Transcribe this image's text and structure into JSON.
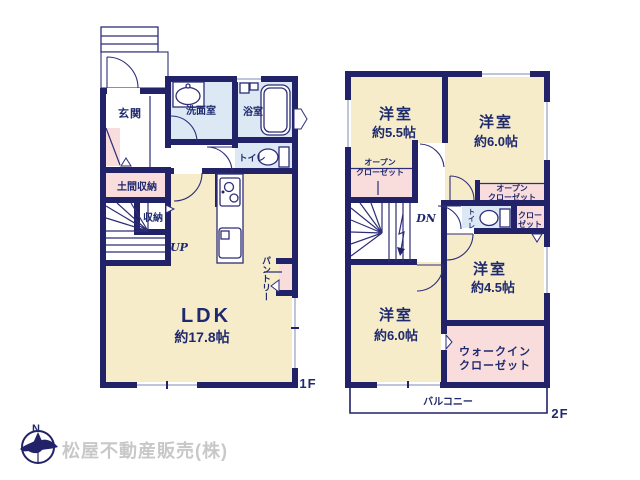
{
  "colors": {
    "wall": "#222269",
    "room_cream": "#f6ecca",
    "wet_blue": "#dce8f4",
    "closet_pink": "#f9dcdc",
    "text_navy": "#1f2a6e",
    "logo_gray": "#c8c8c8"
  },
  "floor1": {
    "label": "1F",
    "genkan": "玄関",
    "washroom": "洗面室",
    "bathroom": "浴室",
    "toilet": "トイレ",
    "doma_storage": "土間収納",
    "storage": "収納",
    "ldk": "LDK",
    "ldk_size": "約17.8帖",
    "pantry": "パントリー",
    "stairs_dir": "UP"
  },
  "floor2": {
    "label": "2F",
    "room55": "洋室",
    "room55_size": "約5.5帖",
    "room60_top": "洋室",
    "room60_top_size": "約6.0帖",
    "room45": "洋室",
    "room45_size": "約4.5帖",
    "room60_bottom": "洋室",
    "room60_bottom_size": "約6.0帖",
    "open_closet_left_line1": "オープン",
    "open_closet_left_line2": "クローゼット",
    "open_closet_right_line1": "オープン",
    "open_closet_right_line2": "クローゼット",
    "closet_line1": "クロー",
    "closet_line2": "ゼット",
    "toilet": "トイレ",
    "wic_line1": "ウォークイン",
    "wic_line2": "クローゼット",
    "balcony": "バルコニー",
    "stairs_dir": "DN"
  },
  "company": {
    "name": "松屋不動産販売(株)",
    "compass_north": "N"
  }
}
